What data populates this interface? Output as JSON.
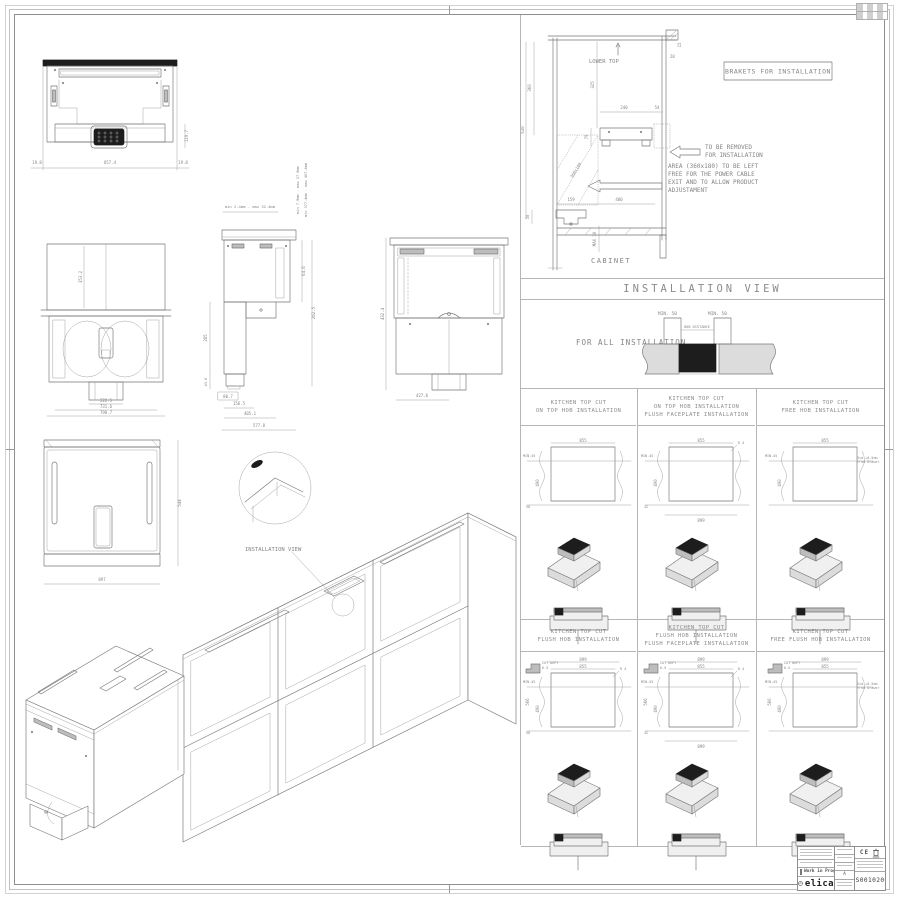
{
  "band": {
    "installation_view": "INSTALLATION VIEW"
  },
  "cabinet": {
    "lower_top": "LOWER TOP",
    "brakets": "BRAKETS FOR INSTALLATION",
    "remove_1": "TO BE REMOVED",
    "remove_2": "FOR INSTALLATION",
    "area_1": "AREA (360x180) TO BE LEFT",
    "area_2": "FREE FOR THE POWER CABLE",
    "area_3": "EXIT AND TO ALLOW PRODUCT",
    "area_4": "ADJUSTAMENT",
    "label": "CABINET",
    "dims": {
      "d360": "360",
      "d638": "638",
      "d325": "325",
      "d240": "240",
      "d54": "54",
      "d79": "79",
      "d20": "20",
      "d15": "15",
      "area": "360x180",
      "d159": "159",
      "d400": "400",
      "d50": "50",
      "max30": "MAX 30"
    }
  },
  "forall": {
    "label": "FOR ALL INSTALLATION",
    "min50_left": "MIN. 50",
    "min50_right": "MIN. 50",
    "hob_distance": "HOB DISTANCE"
  },
  "views": {
    "front": {
      "d_left": "19.8",
      "d_width": "857.4",
      "d_right": "19.8",
      "d_h": "119.7"
    },
    "bottom": {
      "d_inner": "353.2",
      "d_duct": "222.5",
      "d_mid": "731.6",
      "d_out": "798.7"
    },
    "side": {
      "top_range": "min 2.4mm - max 32.4mm",
      "range1": "min 7.9mm - max 37.9mm",
      "range2": "min 377.4mm - max 407.4mm",
      "d285": "285",
      "d436": "43.6",
      "d807": "80.7",
      "d1565": "156.5",
      "d4051": "405.1",
      "d5778": "577.8",
      "d646": "64.6",
      "d2625": "262.5"
    },
    "rear": {
      "d_w": "427.6",
      "d_h": "432.4"
    },
    "top": {
      "d_w": "897",
      "d_d": "544"
    },
    "detail_label": "INSTALLATION VIEW"
  },
  "cut_panels": [
    {
      "h1": "KITCHEN TOP CUT",
      "h2": "ON TOP HOB INSTALLATION",
      "dim_top": "855",
      "dim_min": "MIN.45",
      "dim_h": "490",
      "dim_b": "50"
    },
    {
      "h1": "KITCHEN TOP CUT",
      "h2": "ON TOP HOB INSTALLATION",
      "h3": "FLUSH FACEPLATE INSTALLATION",
      "dim_top": "855",
      "dim_min": "MIN.45",
      "dim_h": "490",
      "dim_b": "42",
      "dim_bottom": "899",
      "radius": "R 4"
    },
    {
      "h1": "KITCHEN TOP CUT",
      "h2": "FREE HOB INSTALLATION",
      "dim_top": "855",
      "dim_min": "MIN.45",
      "dim_h": "490",
      "note": "Dim +0.5mm from Drawer"
    },
    {
      "h1": "KITCHEN TOP CUT",
      "h2": "FLUSH HOB INSTALLATION",
      "cut_dept": "CUT DEPT",
      "cut_dept_val": "6.5",
      "dim_top2": "899",
      "dim_top": "855",
      "dim_left": "566",
      "dim_min": "MIN.45",
      "dim_h": "490",
      "dim_b": "50",
      "radius": "R 4"
    },
    {
      "h1": "KITCHEN TOP CUT",
      "h2": "FLUSH HOB INSTALLATION",
      "h3": "FLUSH FACEPLATE INSTALLATION",
      "cut_dept": "CUT DEPT",
      "cut_dept_val": "6.5",
      "dim_top2": "899",
      "dim_top": "855",
      "dim_left": "566",
      "dim_min": "MIN.45",
      "dim_h": "490",
      "dim_b": "42",
      "dim_bottom": "899",
      "radius": "R 4"
    },
    {
      "h1": "KITCHEN TOP CUT",
      "h2": "FREE FLUSH HOB INSTALLATION",
      "cut_dept": "CUT DEPT",
      "cut_dept_val": "6.5",
      "dim_top2": "899",
      "dim_top": "855",
      "dim_left": "566",
      "dim_min": "MIN.45",
      "dim_h": "490",
      "note": "Dim +0.5mm from Drawer"
    }
  ],
  "title_block": {
    "status": "Work in Progress",
    "rev": "A",
    "brand": "elica",
    "ce": "CE",
    "code": "DS0010200"
  }
}
